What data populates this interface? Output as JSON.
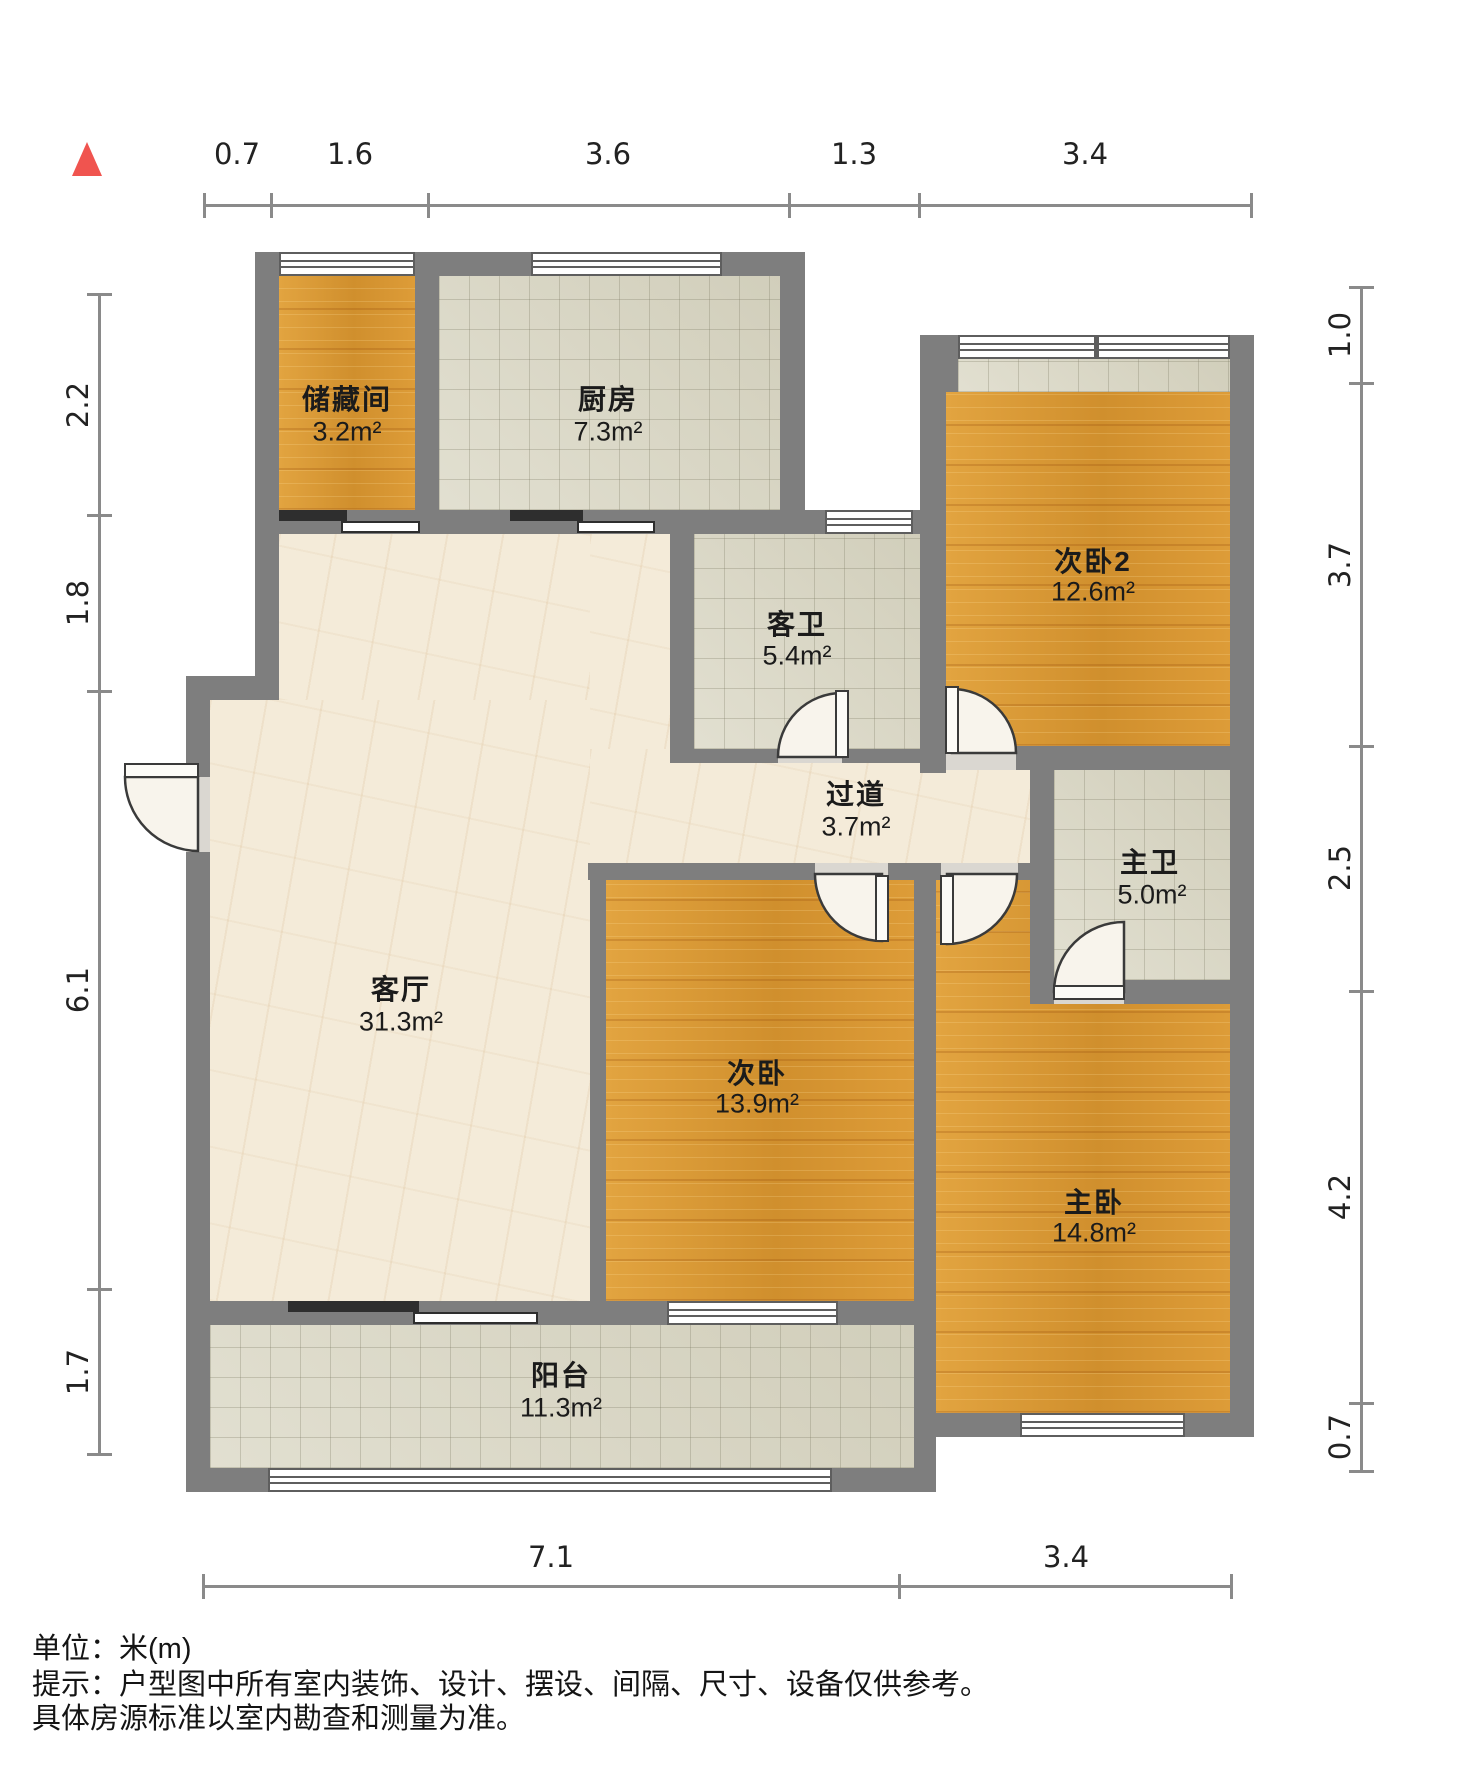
{
  "plan": {
    "type": "residential-floorplan",
    "unit": "米(m)",
    "rooms": [
      {
        "name": "储藏间",
        "area": "3.2m²"
      },
      {
        "name": "厨房",
        "area": "7.3m²"
      },
      {
        "name": "客卫",
        "area": "5.4m²"
      },
      {
        "name": "次卧2",
        "area": "12.6m²"
      },
      {
        "name": "过道",
        "area": "3.7m²"
      },
      {
        "name": "主卫",
        "area": "5.0m²"
      },
      {
        "name": "客厅",
        "area": "31.3m²"
      },
      {
        "name": "次卧",
        "area": "13.9m²"
      },
      {
        "name": "主卧",
        "area": "14.8m²"
      },
      {
        "name": "阳台",
        "area": "11.3m²"
      }
    ],
    "dims": {
      "top": [
        "0.7",
        "1.6",
        "3.6",
        "1.3",
        "3.4"
      ],
      "left": [
        "2.2",
        "1.8",
        "6.1",
        "1.7"
      ],
      "right": [
        "1.0",
        "3.7",
        "2.5",
        "4.2",
        "0.7"
      ],
      "bottom": [
        "7.1",
        "3.4"
      ]
    },
    "footer": {
      "unit": "单位：米(m)",
      "tip1": "提示：户型图中所有室内装饰、设计、摆设、间隔、尺寸、设备仅供参考。",
      "tip2": "具体房源标准以室内勘查和测量为准。"
    },
    "palette": {
      "wall": "#7e7e7e",
      "wood-floor": "#db9a37",
      "tile-floor": "#d8d5c1",
      "marble-floor": "#f4ebd9",
      "north-marker": "#f0544f",
      "sliding-door": "#2e2e2e"
    }
  }
}
